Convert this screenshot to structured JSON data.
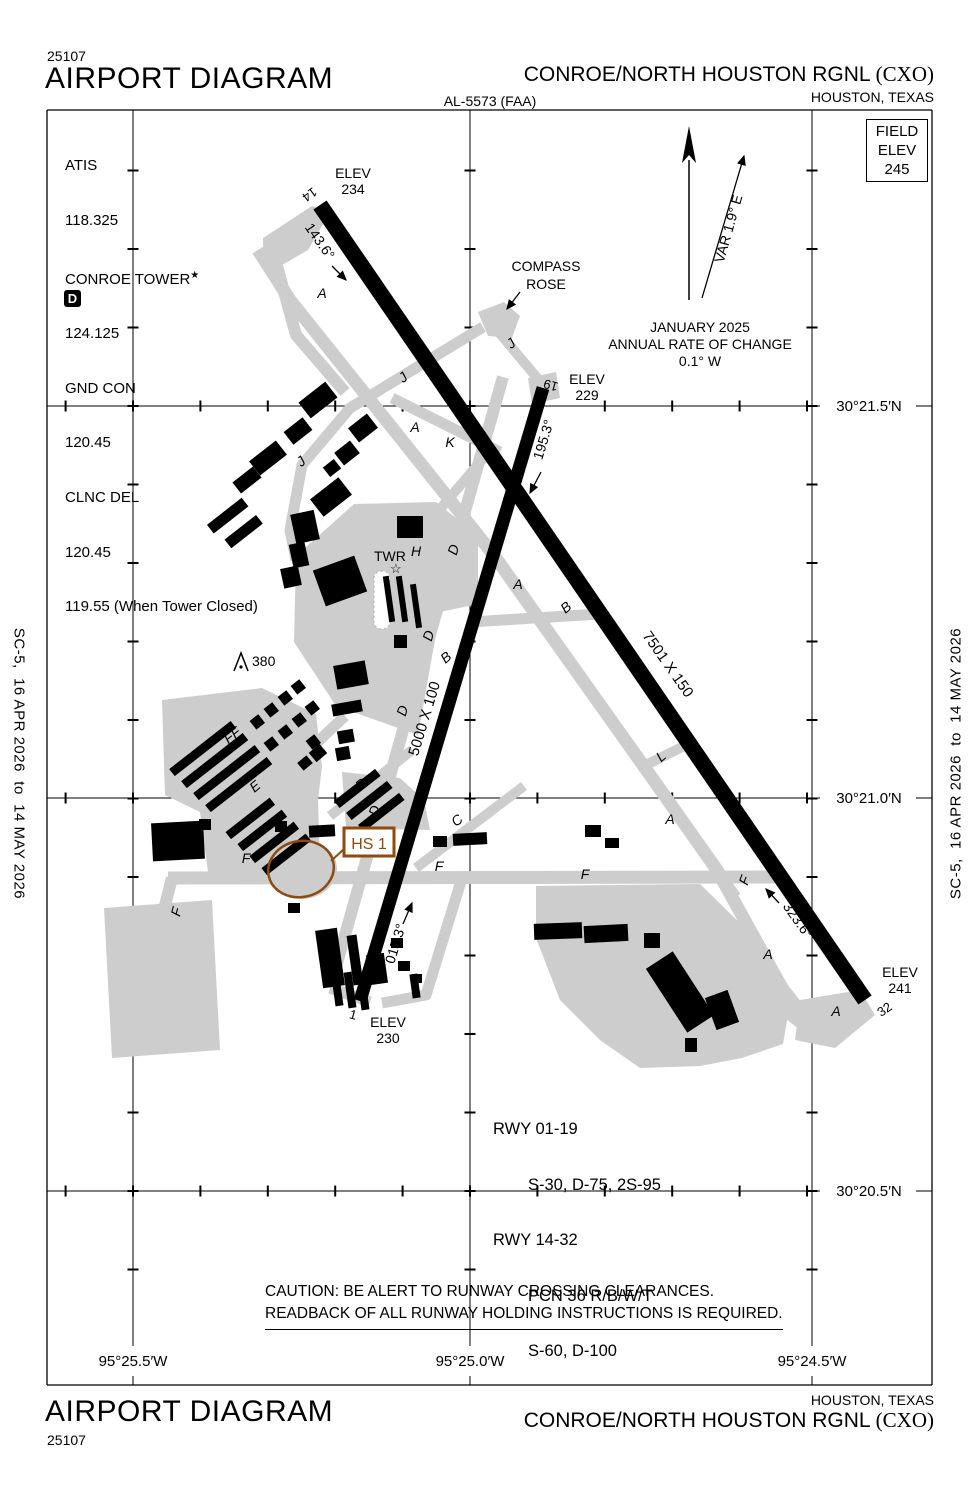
{
  "page": {
    "chart_code_top": "25107",
    "chart_code_bottom": "25107",
    "title_top": "AIRPORT DIAGRAM",
    "title_bottom": "AIRPORT DIAGRAM",
    "procedure_id": "AL-5573 (FAA)",
    "airport_name": "CONROE/NORTH HOUSTON RGNL ",
    "airport_code": "(CXO)",
    "city": "HOUSTON, TEXAS",
    "edition_note": "SC-5,  16 APR 2026  to  14 MAY 2026"
  },
  "field_elev": {
    "line1": "FIELD",
    "line2": "ELEV",
    "line3": "245"
  },
  "comms": {
    "lines": [
      "ATIS",
      "118.325",
      "CONROE TOWER",
      "124.125",
      "GND CON",
      "120.45",
      "CLNC DEL",
      "120.45",
      "119.55 (When Tower Closed)"
    ],
    "tower_star": "★",
    "delivery_symbol": "D"
  },
  "annotations": {
    "compass_line1": "COMPASS",
    "compass_line2": "ROSE",
    "variation": "VAR 1.9° E",
    "mag_line1": "JANUARY 2025",
    "mag_line2": "ANNUAL RATE OF CHANGE",
    "mag_line3": "0.1° W",
    "caution_line1": "CAUTION:  BE ALERT TO RUNWAY CROSSING CLEARANCES.",
    "caution_line2": "READBACK OF ALL RUNWAY HOLDING INSTRUCTIONS IS REQUIRED.",
    "tower_label": "TWR",
    "tower_star_icon": "☆",
    "obstruction_value": "380",
    "hot_spot_label": "HS 1"
  },
  "runways": {
    "rwy_14_32": {
      "dim": "7501 X 150",
      "end14": {
        "num": "14",
        "elev_label": "ELEV",
        "elev": "234",
        "hdg": "143.6°"
      },
      "end32": {
        "num": "32",
        "elev_label": "ELEV",
        "elev": "241",
        "hdg": "323.6°"
      }
    },
    "rwy_01_19": {
      "dim": "5000 X 100",
      "end1": {
        "num": "1",
        "elev_label": "ELEV",
        "elev": "230",
        "hdg": "015.3°"
      },
      "end19": {
        "num": "19",
        "elev_label": "ELEV",
        "elev": "229",
        "hdg": "195.3°"
      }
    }
  },
  "rwy_data": {
    "l1": "RWY 01-19",
    "l2": "S-30, D-75, 2S-95",
    "l3": "RWY 14-32",
    "l4": "PCN 36 R/B/W/T",
    "l5": "S-60, D-100"
  },
  "grid": {
    "lat": [
      "30°21.5′N",
      "30°21.0′N",
      "30°20.5′N"
    ],
    "lon": [
      "95°25.5′W",
      "95°25.0′W",
      "95°24.5′W"
    ]
  },
  "taxiway_labels": [
    {
      "t": "A",
      "x": 322,
      "y": 298,
      "r": 0
    },
    {
      "t": "A",
      "x": 415,
      "y": 432,
      "r": 0
    },
    {
      "t": "A",
      "x": 518,
      "y": 589,
      "r": 0
    },
    {
      "t": "A",
      "x": 670,
      "y": 824,
      "r": 0
    },
    {
      "t": "A",
      "x": 768,
      "y": 959,
      "r": 0
    },
    {
      "t": "A",
      "x": 836,
      "y": 1016,
      "r": 0
    },
    {
      "t": "J",
      "x": 514,
      "y": 347,
      "r": -40
    },
    {
      "t": "J",
      "x": 406,
      "y": 381,
      "r": -40
    },
    {
      "t": "J",
      "x": 304,
      "y": 465,
      "r": -40
    },
    {
      "t": "K",
      "x": 450,
      "y": 447,
      "r": 0
    },
    {
      "t": "D",
      "x": 458,
      "y": 551,
      "r": -73
    },
    {
      "t": "D",
      "x": 433,
      "y": 637,
      "r": -73
    },
    {
      "t": "D",
      "x": 407,
      "y": 712,
      "r": -73
    },
    {
      "t": "D",
      "x": 379,
      "y": 812,
      "r": -73
    },
    {
      "t": "D",
      "x": 330,
      "y": 945,
      "r": -73
    },
    {
      "t": "B",
      "x": 449,
      "y": 661,
      "r": -40
    },
    {
      "t": "B",
      "x": 569,
      "y": 611,
      "r": -40
    },
    {
      "t": "H",
      "x": 416,
      "y": 556,
      "r": 0
    },
    {
      "t": "E",
      "x": 258,
      "y": 790,
      "r": -40
    },
    {
      "t": "R",
      "x": 364,
      "y": 788,
      "r": -40
    },
    {
      "t": "C",
      "x": 460,
      "y": 824,
      "r": -40
    },
    {
      "t": "L",
      "x": 664,
      "y": 760,
      "r": -40
    },
    {
      "t": "F",
      "x": 246,
      "y": 863,
      "r": 0
    },
    {
      "t": "F",
      "x": 439,
      "y": 871,
      "r": 0
    },
    {
      "t": "F",
      "x": 585,
      "y": 879,
      "r": 0
    },
    {
      "t": "F",
      "x": 749,
      "y": 882,
      "r": -70
    },
    {
      "t": "F",
      "x": 181,
      "y": 913,
      "r": -75
    },
    {
      "t": "FF",
      "x": 235,
      "y": 739,
      "r": -38
    }
  ],
  "colors": {
    "hot_spot_brown": "#8e4a10",
    "taxiway_gray": "#cdcdcd"
  }
}
